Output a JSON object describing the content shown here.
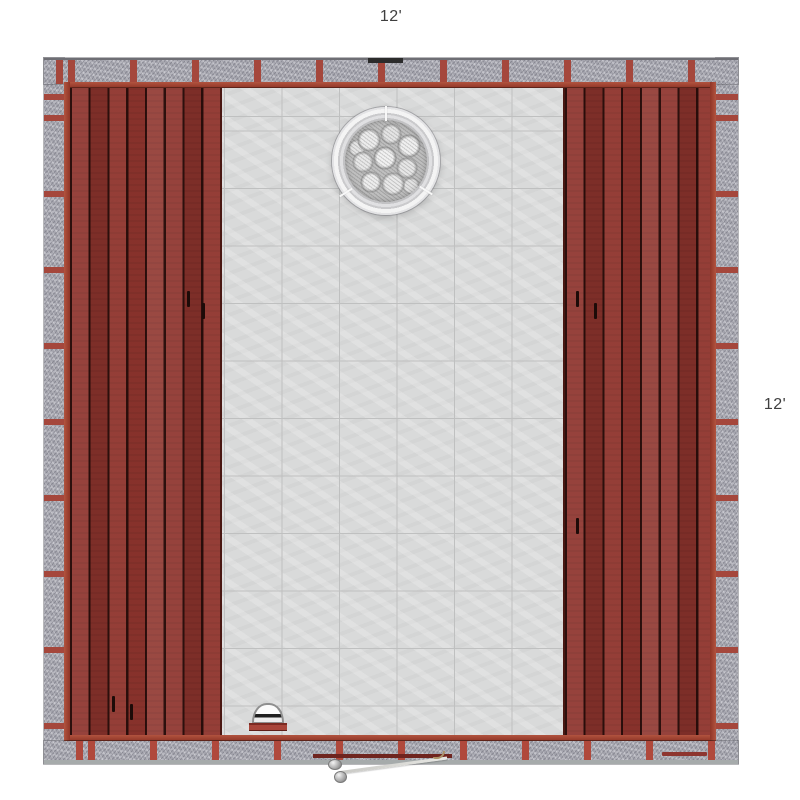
{
  "page": {
    "type": "product-render",
    "subject": "Sauna room floor plan, top-down view"
  },
  "labels": {
    "width_top": "12'",
    "depth_right": "12'"
  },
  "objects": {
    "heater": "rock-heater",
    "light": "dome-light",
    "door": "open-door-swing",
    "benches": "red-wood-benches",
    "floor": "grey-tile-floor",
    "walls": "stone-segment-walls"
  },
  "colors": {
    "background": "#ffffff",
    "bench_wood": "#8e342d",
    "frame_red": "#a5473c",
    "wall_stone": "#a4a4ad",
    "floor_tile": "#d9dada",
    "grout": "#bfc0c0",
    "heater_rim": "#f4f4f4",
    "rock_grey": "#bfbfbf",
    "label_text": "#3f3f3f"
  }
}
